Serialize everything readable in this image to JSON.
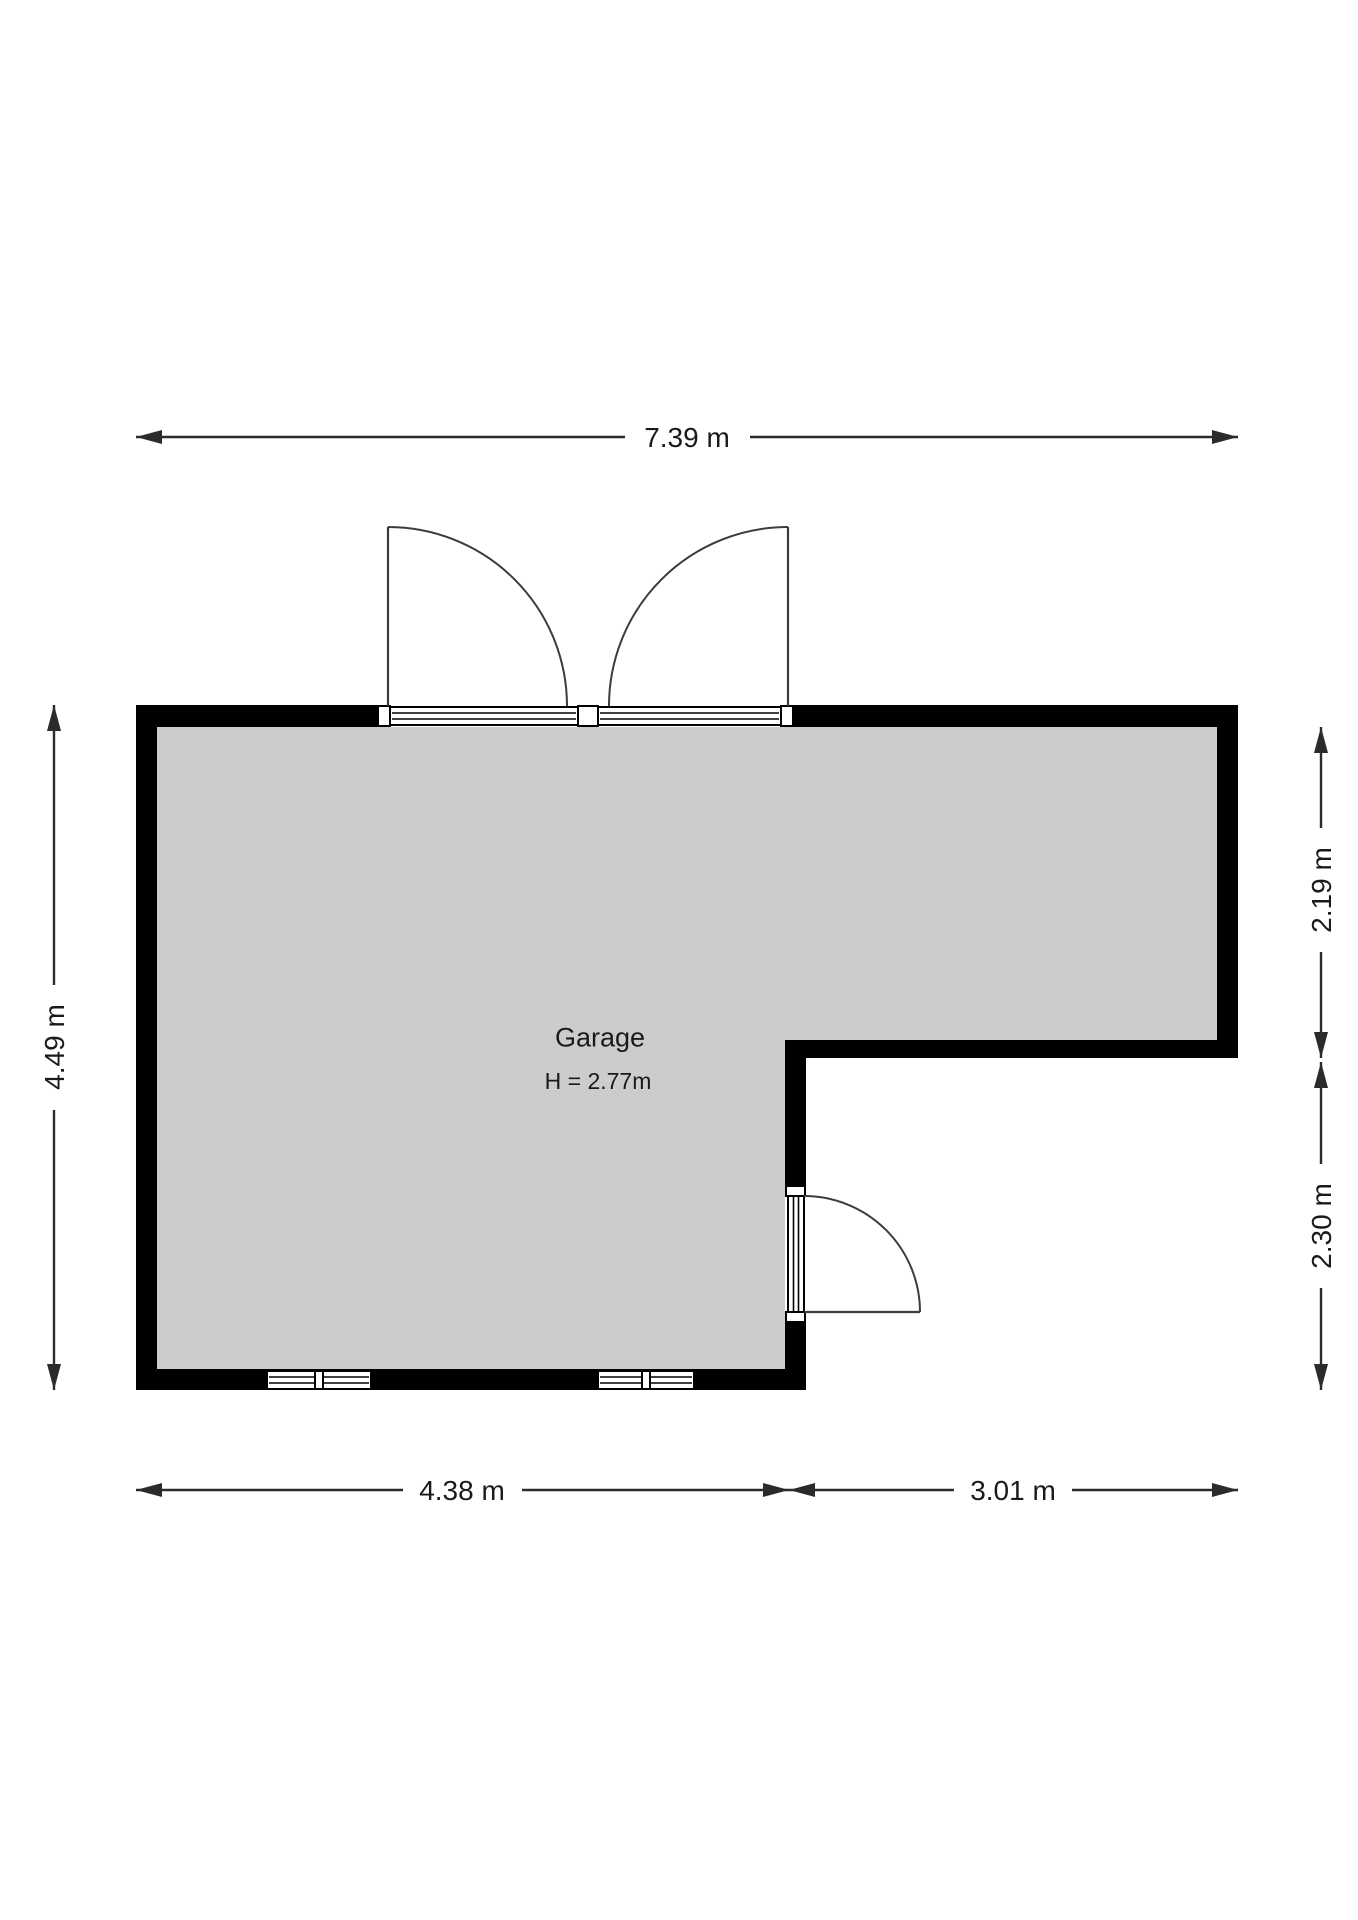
{
  "plan": {
    "room_label": "Garage",
    "room_height_label": "H = 2.77m"
  },
  "dimensions": {
    "top": "7.39 m",
    "left": "4.49 m",
    "right_upper": "2.19 m",
    "right_lower": "2.30 m",
    "bottom_left": "4.38 m",
    "bottom_right": "3.01 m"
  },
  "colors": {
    "wall": "#000000",
    "floor": "#cccccc",
    "line": "#2b2b2b",
    "background": "#ffffff",
    "text": "#1a1a1a"
  }
}
